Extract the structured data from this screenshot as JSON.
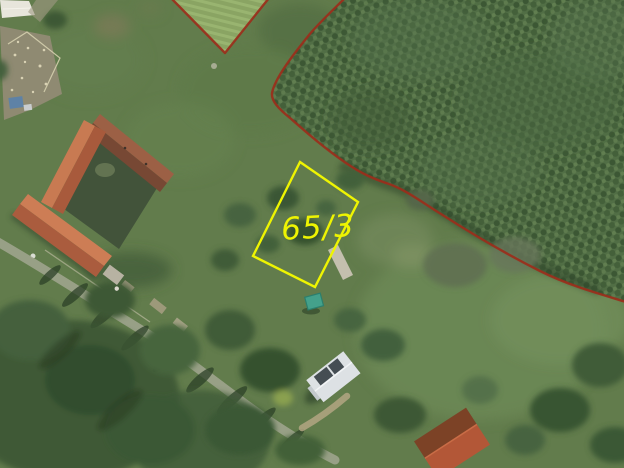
{
  "map": {
    "view": "aerial-photo-with-cadastral-overlay",
    "parcel": {
      "label": "65/3",
      "outline_color": "#eef402"
    },
    "boundary": {
      "color": "#9b2e1b"
    }
  }
}
